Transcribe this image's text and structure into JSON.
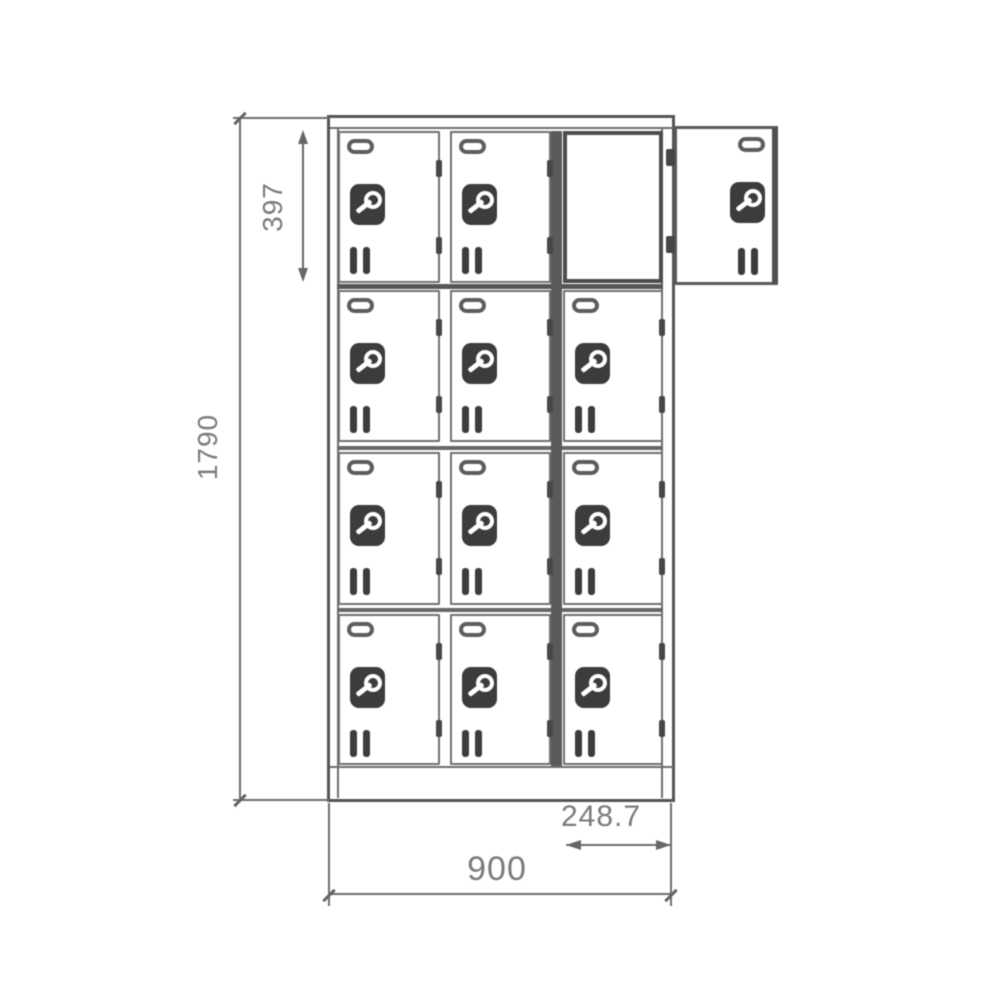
{
  "drawing": {
    "dimensions": {
      "overall_height": "1790",
      "door_height": "397",
      "overall_width": "900",
      "door_width": "248.7"
    },
    "cabinet": {
      "rows": 4,
      "columns": 3,
      "open_cell": {
        "row": 0,
        "col": 2
      },
      "detached_door_shown": true
    },
    "door_features": [
      "card-holder",
      "cam-lock",
      "vent-slits",
      "hinges"
    ],
    "colors": {
      "line": "#6e6e6e",
      "dark": "#545454",
      "hardware": "#3c3c3c",
      "dim_text": "#7b7b7b",
      "background": "#ffffff"
    }
  }
}
